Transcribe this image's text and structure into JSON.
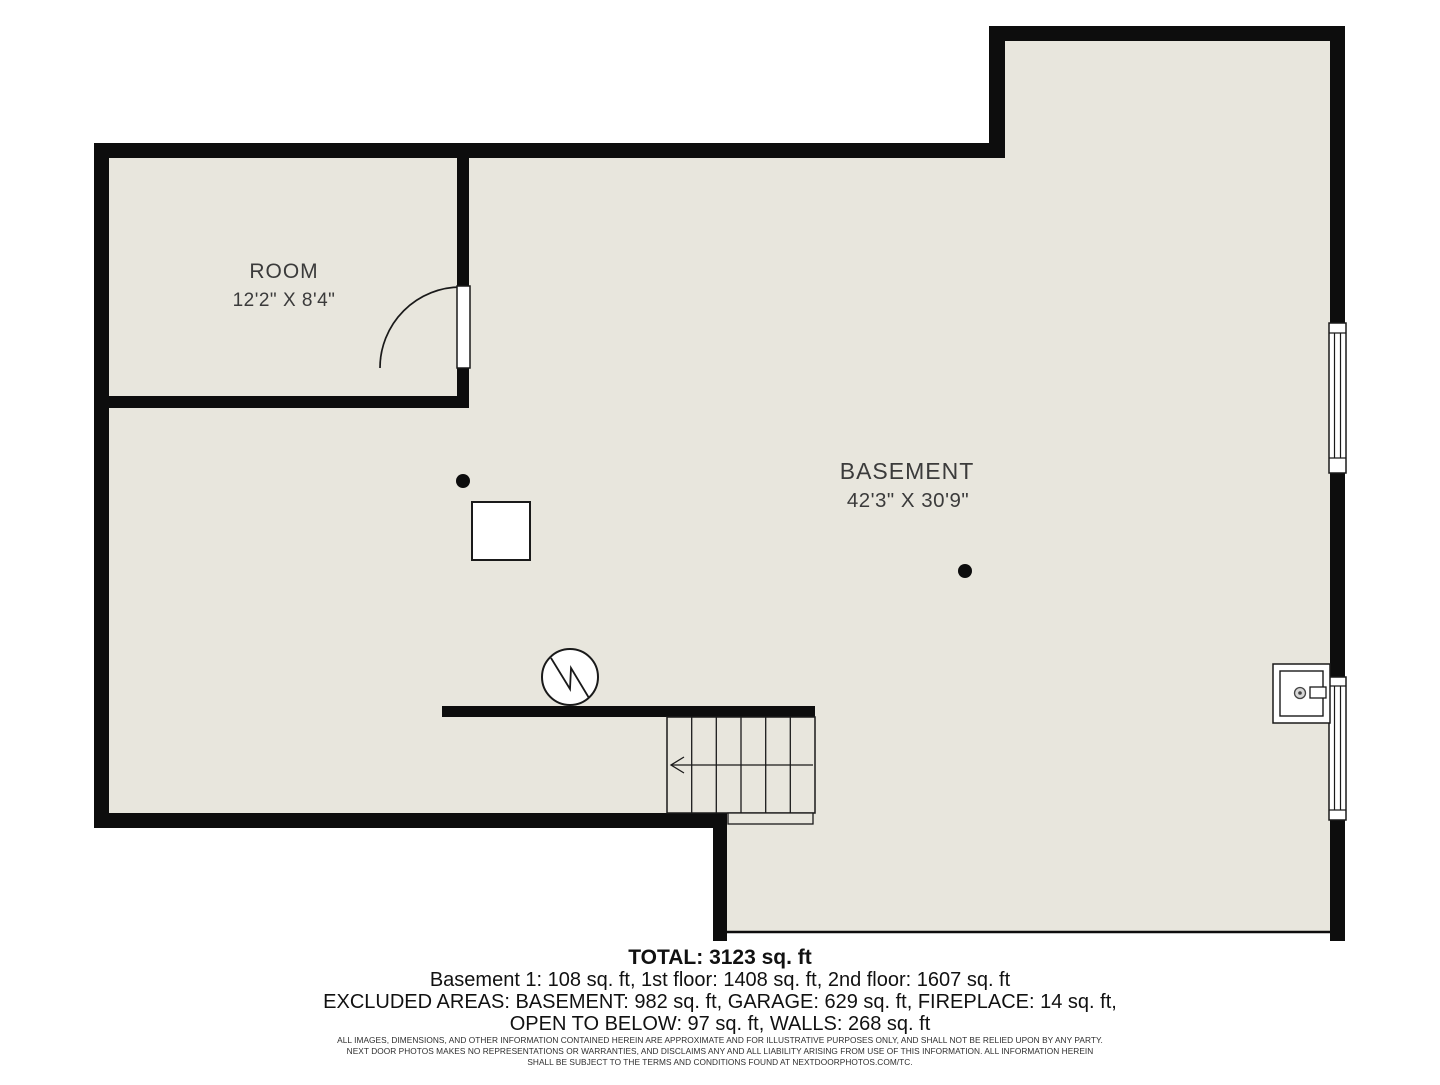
{
  "colors": {
    "background": "#ffffff",
    "floor": "#e8e6dd",
    "wall": "#0d0d0d",
    "symbol_stroke": "#1a1a1a",
    "room_label": "#3b3b3b",
    "summary_text": "#111111"
  },
  "floorplan": {
    "rooms": [
      {
        "label": "ROOM",
        "dimensions": "12'2\" X 8'4\""
      },
      {
        "label": "BASEMENT",
        "dimensions": "42'3\" X 30'9\""
      }
    ],
    "symbols": [
      "door-swing",
      "window",
      "window",
      "support-post-dot",
      "support-post-dot",
      "furnace-circle-zigzag",
      "utility-column-square",
      "utility-sink",
      "stairs-with-down-arrow"
    ]
  },
  "summary": {
    "total": "TOTAL: 3123 sq. ft",
    "floors": "Basement 1: 108 sq. ft, 1st floor: 1408 sq. ft, 2nd floor: 1607 sq. ft",
    "excluded_line1": "EXCLUDED AREAS: BASEMENT: 982 sq. ft, GARAGE: 629 sq. ft, FIREPLACE: 14 sq. ft,",
    "excluded_line2": "OPEN TO BELOW: 97 sq. ft, WALLS: 268 sq. ft"
  },
  "disclaimer": {
    "line1": "ALL IMAGES, DIMENSIONS, AND OTHER INFORMATION CONTAINED HEREIN ARE APPROXIMATE AND FOR ILLUSTRATIVE PURPOSES ONLY, AND SHALL NOT BE RELIED UPON BY ANY PARTY.",
    "line2": "NEXT DOOR PHOTOS MAKES NO REPRESENTATIONS OR WARRANTIES, AND DISCLAIMS ANY AND ALL LIABILITY ARISING FROM USE OF THIS INFORMATION. ALL INFORMATION HEREIN",
    "line3": "SHALL BE SUBJECT TO THE TERMS AND CONDITIONS FOUND AT NEXTDOORPHOTOS.COM/TC."
  }
}
